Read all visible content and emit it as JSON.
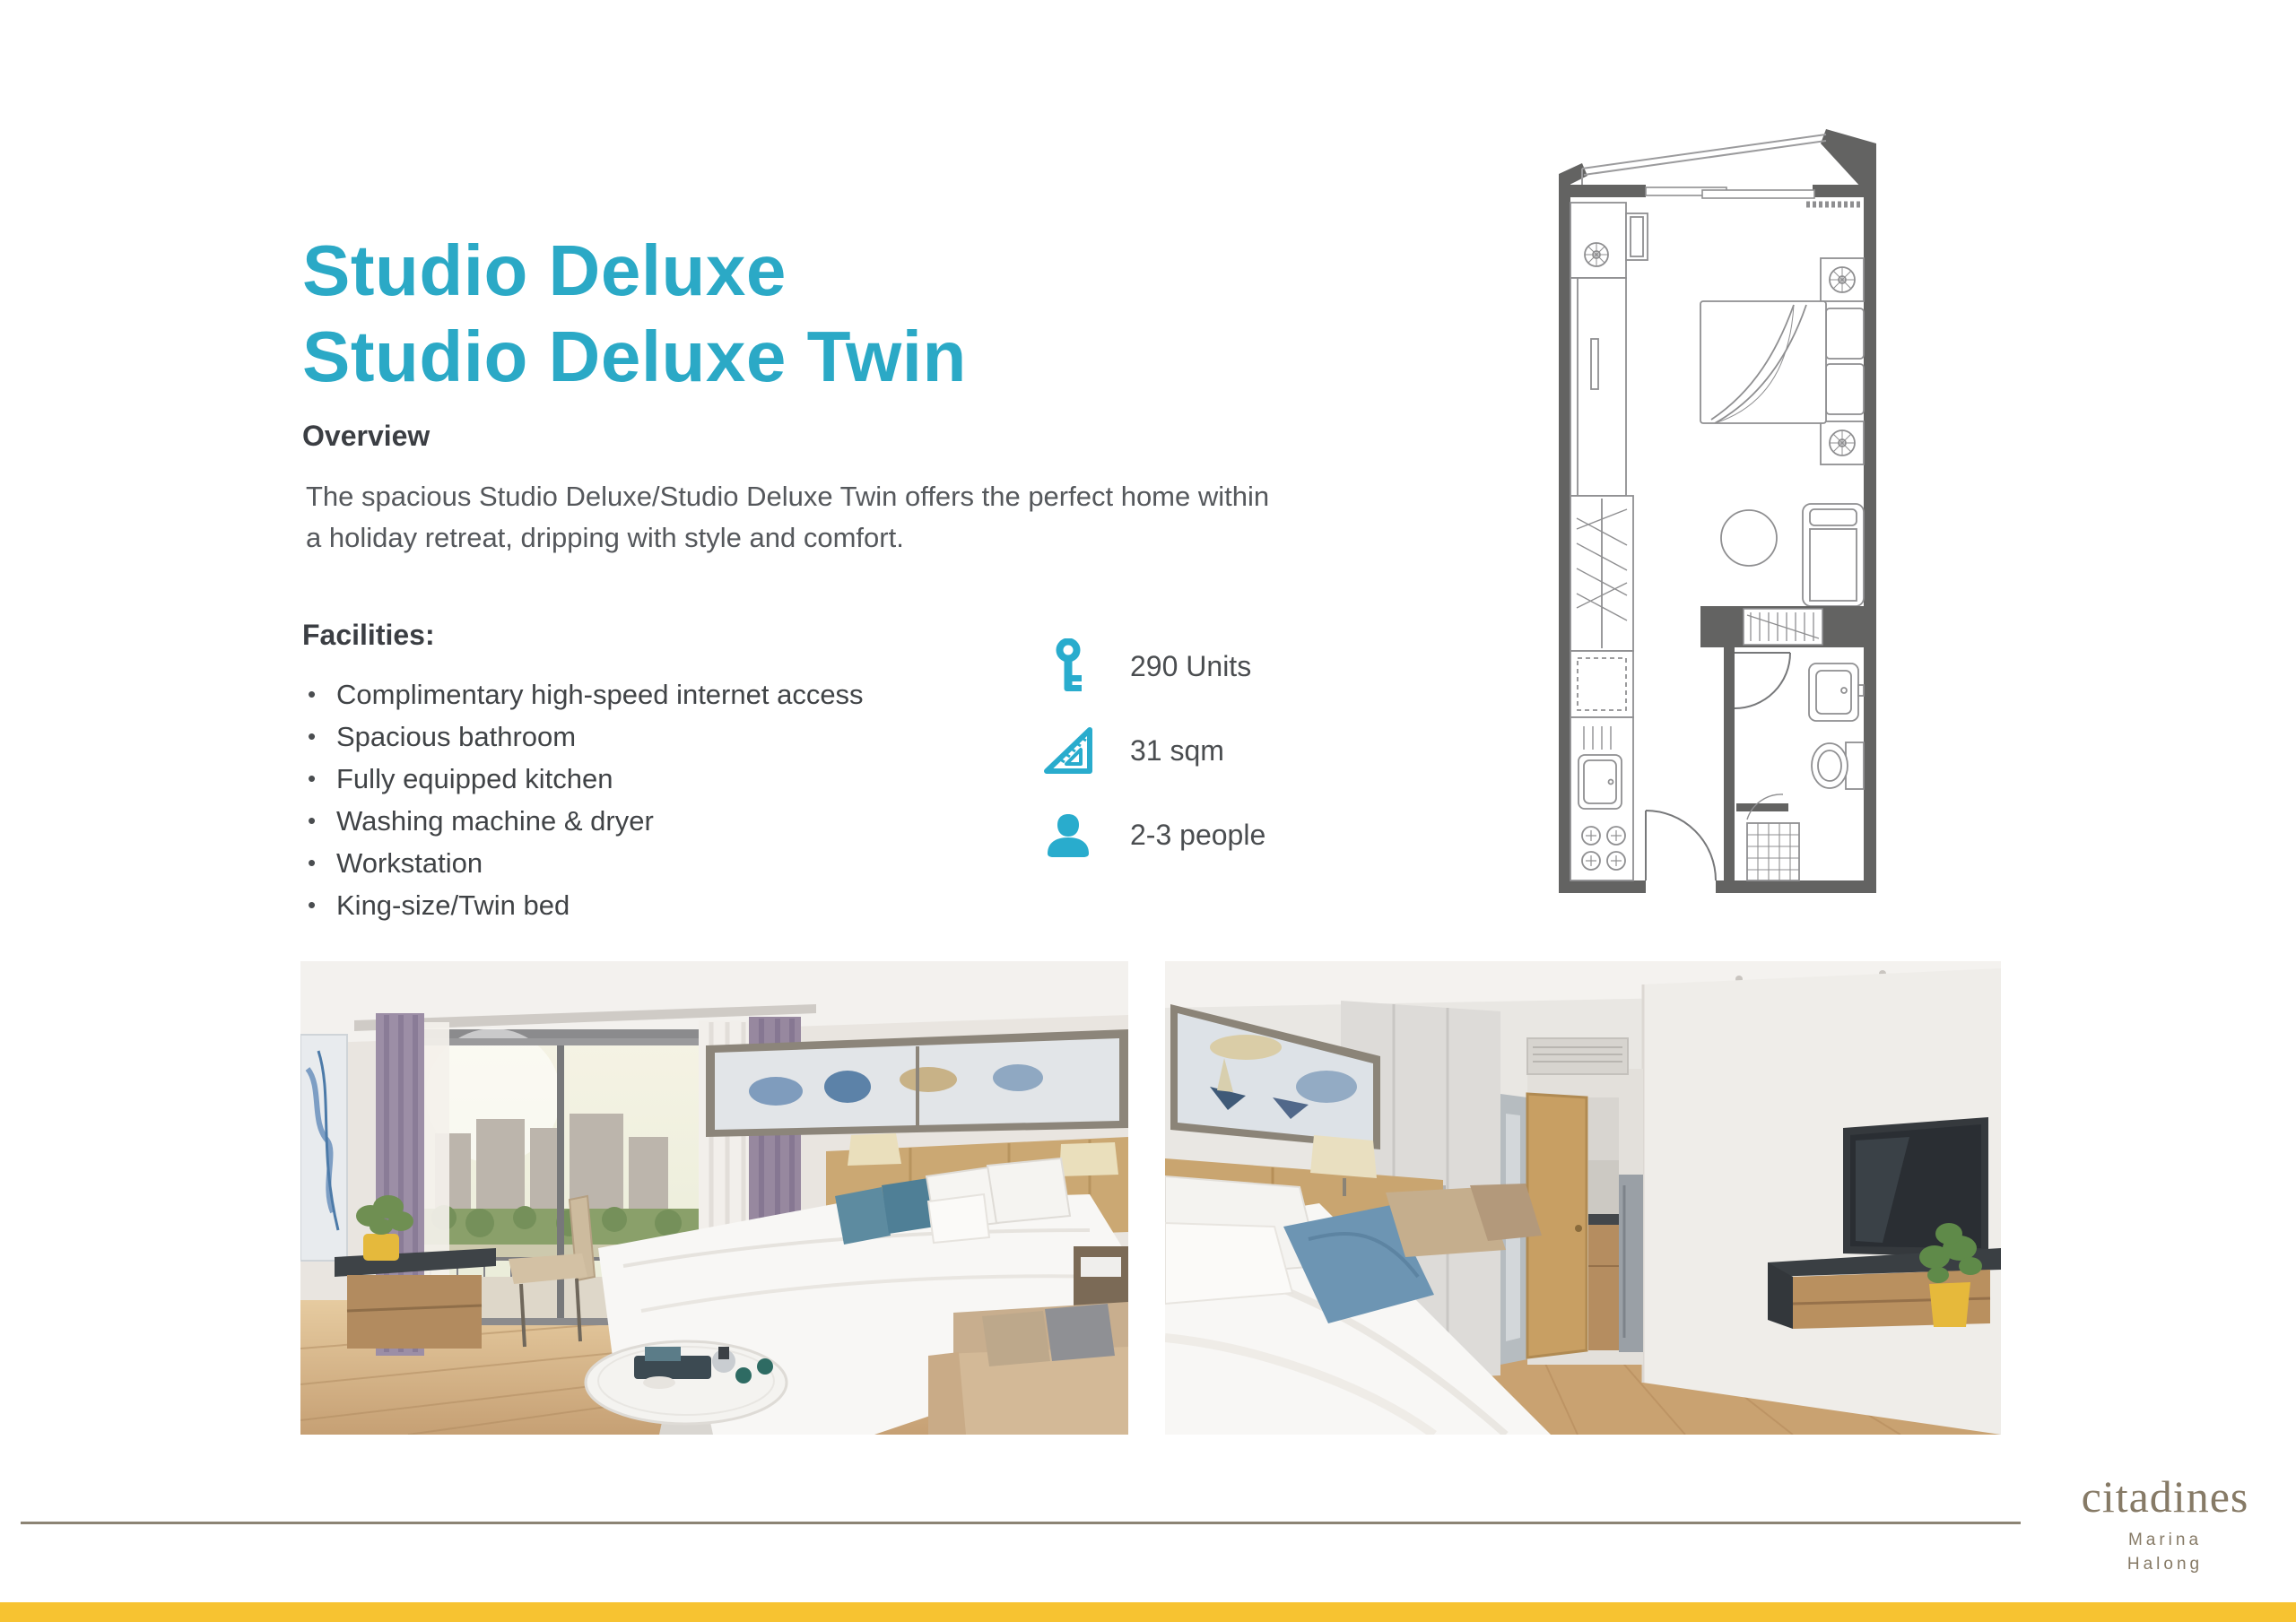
{
  "title": {
    "line1": "Studio Deluxe",
    "line2": "Studio Deluxe Twin"
  },
  "overview": {
    "heading": "Overview",
    "body": "The spacious Studio Deluxe/Studio Deluxe Twin offers the perfect home within a holiday retreat, dripping with style and comfort."
  },
  "facilities": {
    "heading": "Facilities:",
    "items": [
      "Complimentary high-speed internet access",
      "Spacious bathroom",
      "Fully equipped kitchen",
      "Washing machine & dryer",
      "Workstation",
      "King-size/Twin bed"
    ]
  },
  "stats": {
    "units": {
      "icon": "key-icon",
      "label": "290 Units"
    },
    "area": {
      "icon": "set-square-icon",
      "label": "31 sqm"
    },
    "occupancy": {
      "icon": "person-icon",
      "label": "2-3 people"
    }
  },
  "brand": {
    "name": "citadines",
    "location_line1": "Marina",
    "location_line2": "Halong"
  },
  "colors": {
    "accent_teal": "#2BA9C6",
    "icon_teal": "#29ACCD",
    "footer_bar_yellow": "#F7C331",
    "brand_taupe": "#867A66",
    "floorplan_wall_gray": "#636362"
  }
}
